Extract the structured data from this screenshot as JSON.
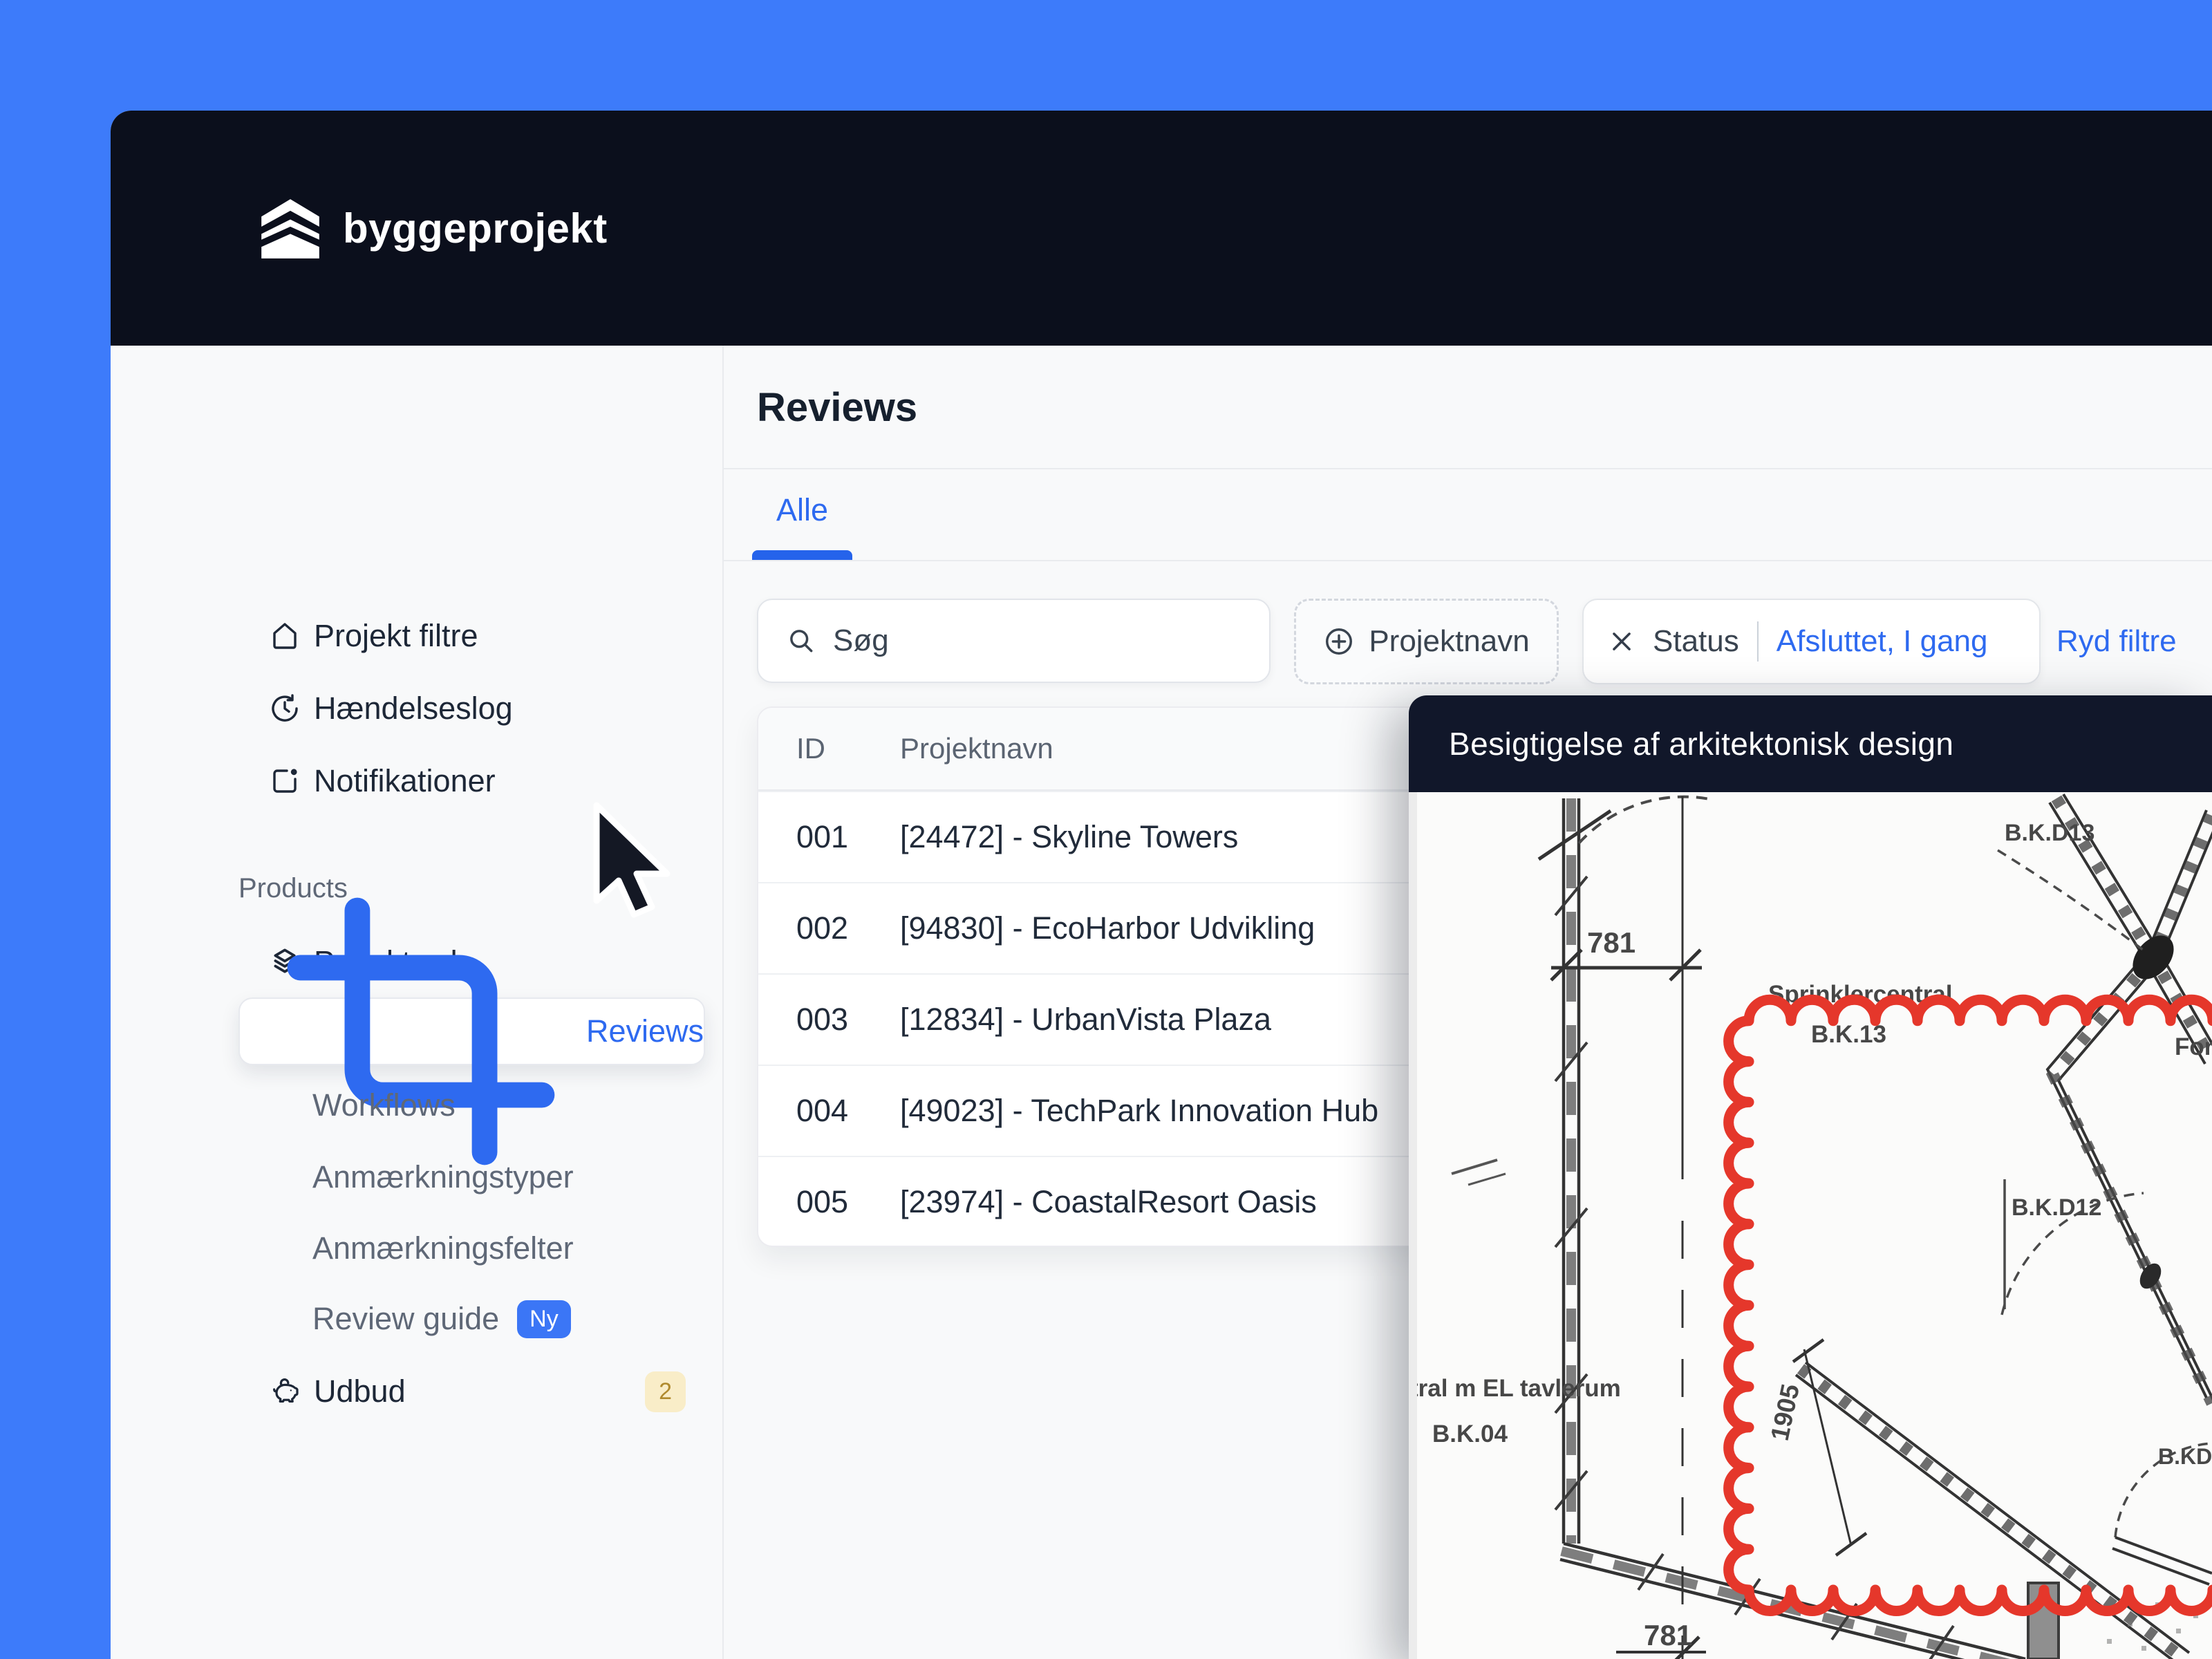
{
  "colors": {
    "background_blue": "#3d7bfa",
    "header_bg": "#0b0f1c",
    "accent_blue": "#2e6af0",
    "annotation_red": "#e5372b",
    "badge_yellow_bg": "#f9edc8",
    "badge_yellow_text": "#b08a2e"
  },
  "brand": {
    "name": "byggeprojekt",
    "logo_icon": "stacked-layers-icon"
  },
  "sidebar": {
    "items": [
      {
        "label": "Projekt filtre",
        "icon": "home-icon"
      },
      {
        "label": "Hændelseslog",
        "icon": "history-clock-icon"
      },
      {
        "label": "Notifikationer",
        "icon": "notification-icon"
      }
    ],
    "section_label": "Products",
    "product_items": [
      {
        "label": "Projektweb",
        "icon": "layers-icon"
      },
      {
        "label": "Reviews",
        "icon": "crop-icon",
        "active": true
      },
      {
        "label": "Workflows"
      },
      {
        "label": "Anmærkningstyper"
      },
      {
        "label": "Anmærkningsfelter"
      },
      {
        "label": "Review guide",
        "badge": "Ny"
      },
      {
        "label": "Udbud",
        "icon": "piggy-bank-icon",
        "badge": "2"
      }
    ]
  },
  "main": {
    "title": "Reviews",
    "tab": "Alle",
    "search_placeholder": "Søg",
    "filter_add": "Projektnavn",
    "filter_status_label": "Status",
    "filter_status_value": "Afsluttet, I gang",
    "clear_filters": "Ryd filtre",
    "table": {
      "col_id": "ID",
      "col_name": "Projektnavn",
      "rows": [
        {
          "id": "001",
          "name": "[24472] - Skyline Towers"
        },
        {
          "id": "002",
          "name": "[94830] - EcoHarbor Udvikling"
        },
        {
          "id": "003",
          "name": "[12834] - UrbanVista Plaza"
        },
        {
          "id": "004",
          "name": "[49023] - TechPark Innovation Hub"
        },
        {
          "id": "005",
          "name": "[23974] - CoastalResort Oasis"
        }
      ]
    }
  },
  "overlay": {
    "title": "Besigtigelse af arkitektonisk design",
    "drawing": {
      "dim_top": "781",
      "dim_bottom": "781",
      "dim_vertical": "1905",
      "label_bkd13": "B.K.D13",
      "label_bkd12": "B.K.D12",
      "label_bkd_cut": "B.KD",
      "label_sprinkler": "Sprinklercentral",
      "label_bk13": "B.K.13",
      "label_for_cut": "For",
      "label_room_1": "tral m EL tavlerum",
      "label_room_2": "B.K.04"
    }
  }
}
